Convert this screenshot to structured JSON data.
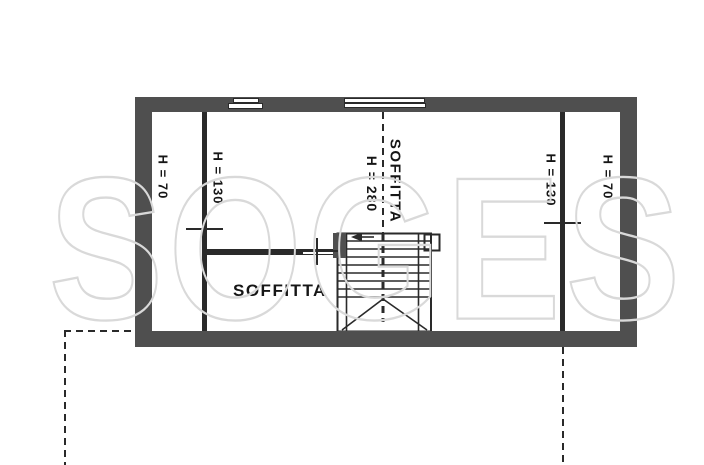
{
  "plan": {
    "watermark": "SOGES",
    "rooms": {
      "left_strip_height": "H = 70",
      "left_inner_height": "H = 130",
      "center_height": "H = 280",
      "center_room": "SOFFITTA",
      "right_inner_height": "H = 130",
      "right_strip_height": "H = 70",
      "lower_room": "SOFFITTA"
    },
    "colors": {
      "wall": "#4f4f4f",
      "line": "#2a2a2a",
      "text": "#161616",
      "watermark": "#d9d9d9"
    }
  }
}
